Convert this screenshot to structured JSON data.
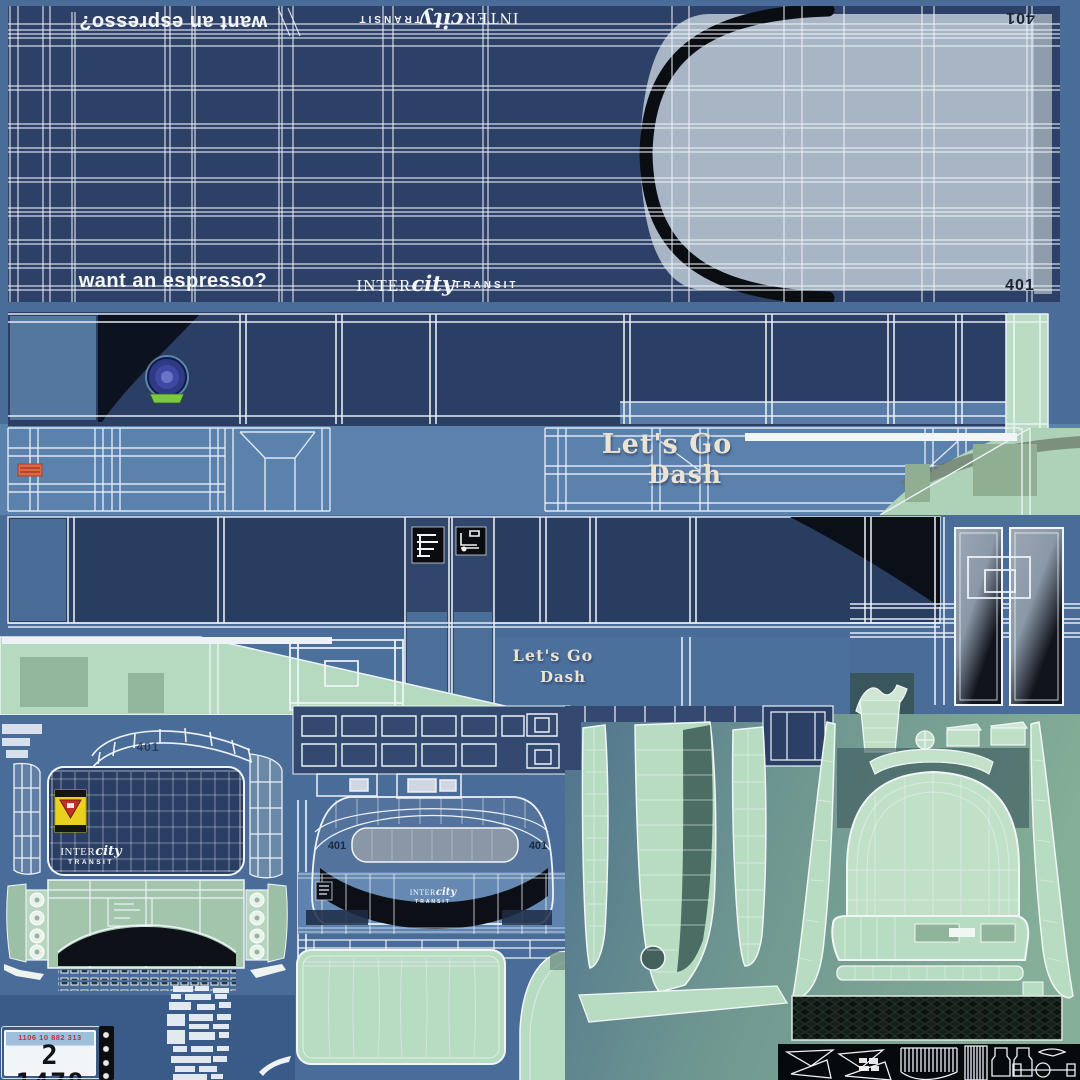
{
  "colors": {
    "background_blue": "#4a6c98",
    "panel_navy": "#2d4168",
    "window_navy": "#293d60",
    "mid_blue": "#5b82ac",
    "mint_green": "#b7dcc1",
    "roof_gray": "#a7b5c4",
    "swoosh_black": "#0b1018",
    "cream_text": "#ece4d2",
    "decal_yellow": "#e8d11f",
    "decal_red": "#c03028",
    "plate_red": "#c23333"
  },
  "brand": {
    "prefix": "INTER",
    "script": "city",
    "suffix": "TRANSIT"
  },
  "top_panel": {
    "slogan": "want an espresso?",
    "slogan_flipped": "want an espresso?",
    "roof_number": "401",
    "roof_number_flipped": "401"
  },
  "side_band": {
    "tagline_line1": "Let's Go",
    "tagline_line2": "Dash"
  },
  "lower_band": {
    "tagline_line1": "Let's Go",
    "tagline_line2": "Dash"
  },
  "front": {
    "number_left": "401",
    "number_right": "401"
  },
  "rear": {
    "number": "401"
  },
  "license_plate": {
    "serial": "1106 10 882 313",
    "number": "2 1478"
  }
}
